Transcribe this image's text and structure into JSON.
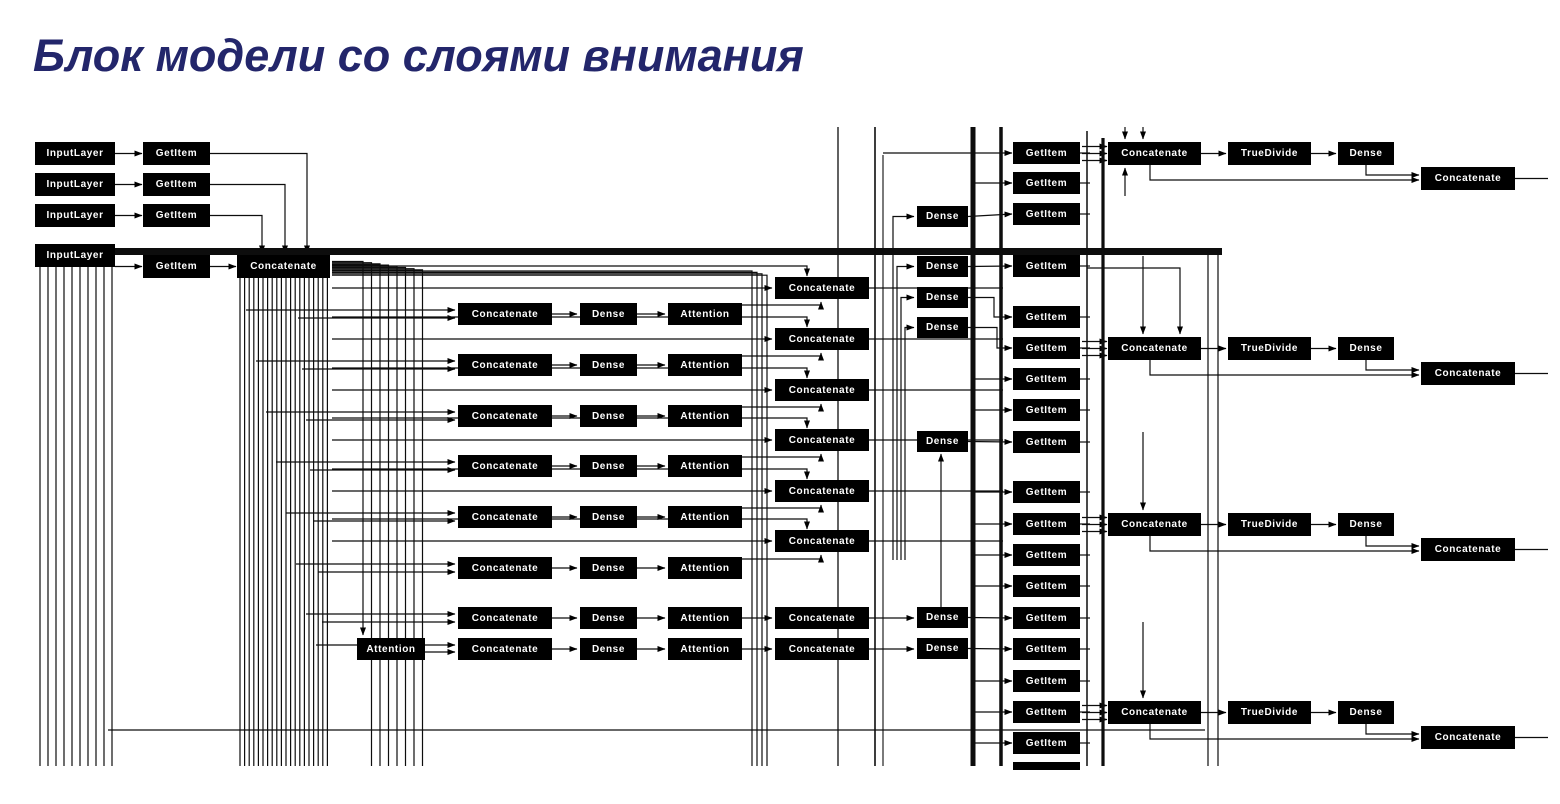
{
  "title": {
    "text": "Блок модели со слоями внимания",
    "color": "#23266b"
  },
  "diagram": {
    "background": "#ffffff",
    "node_style": {
      "bg": "#000000",
      "text_color": "#ffffff"
    },
    "layer_types": [
      "InputLayer",
      "GetItem",
      "Concatenate",
      "Dense",
      "Attention",
      "TrueDivide"
    ],
    "columns": [
      {
        "name": "input-layer",
        "label": "InputLayer",
        "x": 35,
        "w": 80,
        "h": 23,
        "tops": [
          142,
          173,
          204,
          244
        ]
      },
      {
        "name": "getitem-left",
        "label": "GetItem",
        "x": 143,
        "w": 67,
        "h": 23,
        "tops": [
          142,
          173,
          204,
          255
        ]
      },
      {
        "name": "concat-main",
        "label": "Concatenate",
        "x": 237,
        "w": 93,
        "h": 23,
        "tops": [
          255
        ]
      },
      {
        "name": "concat-mid",
        "label": "Concatenate",
        "x": 458,
        "w": 94,
        "h": 22,
        "tops": [
          303,
          354,
          405,
          455,
          506,
          557,
          607,
          638
        ]
      },
      {
        "name": "dense-mid",
        "label": "Dense",
        "x": 580,
        "w": 57,
        "h": 22,
        "tops": [
          303,
          354,
          405,
          455,
          506,
          557,
          607,
          638
        ]
      },
      {
        "name": "attention",
        "label": "Attention",
        "x": 668,
        "w": 74,
        "h": 22,
        "tops": [
          303,
          354,
          405,
          455,
          506,
          557,
          607,
          638
        ]
      },
      {
        "name": "attention-side",
        "label": "Attention",
        "x": 357,
        "w": 68,
        "h": 22,
        "tops": [
          638
        ]
      },
      {
        "name": "concat-2",
        "label": "Concatenate",
        "x": 775,
        "w": 94,
        "h": 22,
        "tops": [
          277,
          328,
          379,
          429,
          480,
          530,
          607,
          638
        ]
      },
      {
        "name": "dense-2",
        "label": "Dense",
        "x": 917,
        "w": 51,
        "h": 21,
        "tops": [
          206,
          256,
          287,
          317,
          431,
          607,
          638
        ]
      },
      {
        "name": "getitem-right",
        "label": "GetItem",
        "x": 1013,
        "w": 67,
        "h": 22,
        "tops": [
          142,
          172,
          203,
          255,
          306,
          337,
          368,
          399,
          431,
          481,
          513,
          544,
          575,
          607,
          638,
          670,
          701,
          732
        ]
      },
      {
        "name": "getitem-partial",
        "label": "",
        "x": 1013,
        "w": 67,
        "h": 8,
        "tops": [
          762
        ]
      },
      {
        "name": "concat-3",
        "label": "Concatenate",
        "x": 1108,
        "w": 93,
        "h": 23,
        "tops": [
          142,
          337,
          513,
          701
        ]
      },
      {
        "name": "truedivide",
        "label": "TrueDivide",
        "x": 1228,
        "w": 83,
        "h": 23,
        "tops": [
          142,
          337,
          513,
          701
        ]
      },
      {
        "name": "dense-3",
        "label": "Dense",
        "x": 1338,
        "w": 56,
        "h": 23,
        "tops": [
          142,
          337,
          513,
          701
        ]
      },
      {
        "name": "concat-4",
        "label": "Concatenate",
        "x": 1421,
        "w": 94,
        "h": 23,
        "tops": [
          167,
          362,
          538,
          726
        ]
      }
    ]
  }
}
